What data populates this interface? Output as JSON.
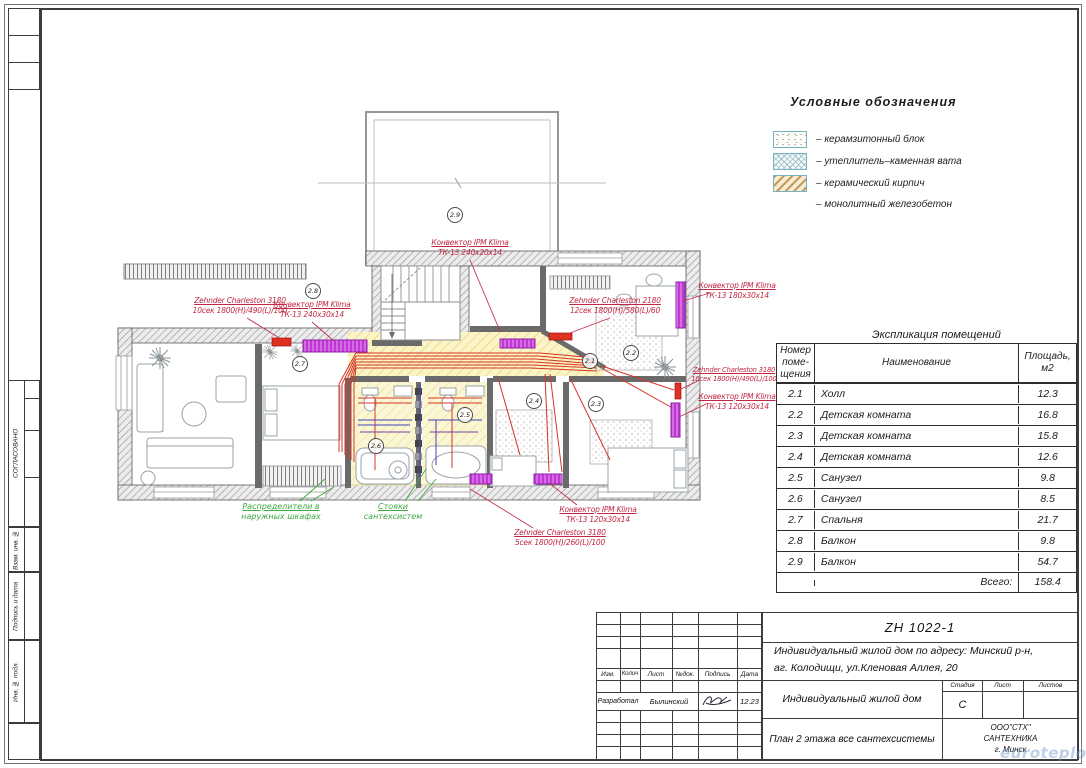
{
  "sheet": {
    "watermark": "euroteplo.by",
    "side_stamp": {
      "approved": "СОГЛАСОВАНО",
      "vzam_inv": "Взам. инв. №",
      "podpis_data": "Подпись и дата",
      "inv_podl": "Инв. № подл."
    }
  },
  "legend": {
    "title": "Условные обозначения",
    "items": [
      {
        "label": "– керамзитонный блок",
        "swatch": "speckle"
      },
      {
        "label": "– утеплитель–каменная вата",
        "swatch": "crosshatch"
      },
      {
        "label": "– керамический кирпич",
        "swatch": "diagonal"
      },
      {
        "label": "– монолитный железобетон",
        "swatch": "none"
      }
    ]
  },
  "rooms_table": {
    "title": "Экспликация помещений",
    "headers": {
      "num": "Номер поме- щения",
      "name": "Наименование",
      "area": "Площадь, м2"
    },
    "rows": [
      {
        "num": "2.1",
        "name": "Холл",
        "area": "12.3"
      },
      {
        "num": "2.2",
        "name": "Детская комната",
        "area": "16.8"
      },
      {
        "num": "2.3",
        "name": "Детская комната",
        "area": "15.8"
      },
      {
        "num": "2.4",
        "name": "Детская комната",
        "area": "12.6"
      },
      {
        "num": "2.5",
        "name": "Санузел",
        "area": "9.8"
      },
      {
        "num": "2.6",
        "name": "Санузел",
        "area": "8.5"
      },
      {
        "num": "2.7",
        "name": "Спальня",
        "area": "21.7"
      },
      {
        "num": "2.8",
        "name": "Балкон",
        "area": "9.8"
      },
      {
        "num": "2.9",
        "name": "Балкон",
        "area": "54.7"
      }
    ],
    "total_label": "Всего:",
    "total": "158.4"
  },
  "plan": {
    "rooms": {
      "r21": "2.1",
      "r22": "2.2",
      "r23": "2.3",
      "r24": "2.4",
      "r25": "2.5",
      "r26": "2.6",
      "r27": "2.7",
      "r28": "2.8",
      "r29": "2.9"
    },
    "labels": {
      "conv_top": {
        "l1": "Конвектор IPM Klima",
        "l2": "ТК-13 240x20x14"
      },
      "zehnder_left": {
        "l1": "Zehnder Charleston 3180",
        "l2": "10сек 1800(H)/490(L)/100"
      },
      "conv_left": {
        "l1": "Конвектор IPM Klima",
        "l2": "ТК-13 240x30x14"
      },
      "zehnder_mid": {
        "l1": "Zehnder Charleston 2180",
        "l2": "12сек 1800(H)/580(L)/60"
      },
      "conv_right_top": {
        "l1": "Конвектор IPM Klima",
        "l2": "ТК-13 180x30x14"
      },
      "zehnder_right": {
        "l1": "Zehnder Charleston 3180",
        "l2": "10сек 1800(H)/490(L)/100"
      },
      "conv_right_mid": {
        "l1": "Конвектор IPM Klima",
        "l2": "ТК-13 120x30x14"
      },
      "conv_bottom": {
        "l1": "Конвектор IPM Klima",
        "l2": "ТК-13 120x30x14"
      },
      "zehnder_bottom": {
        "l1": "Zehnder Charleston 3180",
        "l2": "5сек 1800(H)/260(L)/100"
      }
    },
    "green_labels": {
      "distrib": {
        "l1": "Распределители  в",
        "l2": "наружных шкафах"
      },
      "stacks": {
        "l1": "Стояки",
        "l2": "сантехсистем"
      }
    },
    "colors": {
      "pipe_red": "#d63426",
      "convector_magenta": "#c336d6",
      "hall_yellow": "#faf4c6",
      "label_red": "#c22742",
      "label_green": "#3fa83f"
    }
  },
  "title_block": {
    "code": "ZH 1022-1",
    "address_line1": "Индивидуальный жилой дом по адресу: Минский р-н,",
    "address_line2": "аг. Колодищи, ул.Кленовая Аллея, 20",
    "object_name": "Индивидуальный жилой дом",
    "sheet_title": "План 2 этажа все сантехсистемы",
    "stage_label": "Стадия",
    "stage_value": "С",
    "list_label": "Лист",
    "lists_label": "Листов",
    "header_cols": {
      "izm": "Изм.",
      "kolich": "Колич",
      "list": "Лист",
      "ndok": "№док.",
      "podpis": "Подпись",
      "data": "Дата"
    },
    "developer_role": "Разработал",
    "developer_name": "Былинский",
    "date": "12.23",
    "company_line1": "ООО\"СТХ\"",
    "company_line2": "САНТЕХНИКА",
    "company_line3": "г. Минск"
  }
}
